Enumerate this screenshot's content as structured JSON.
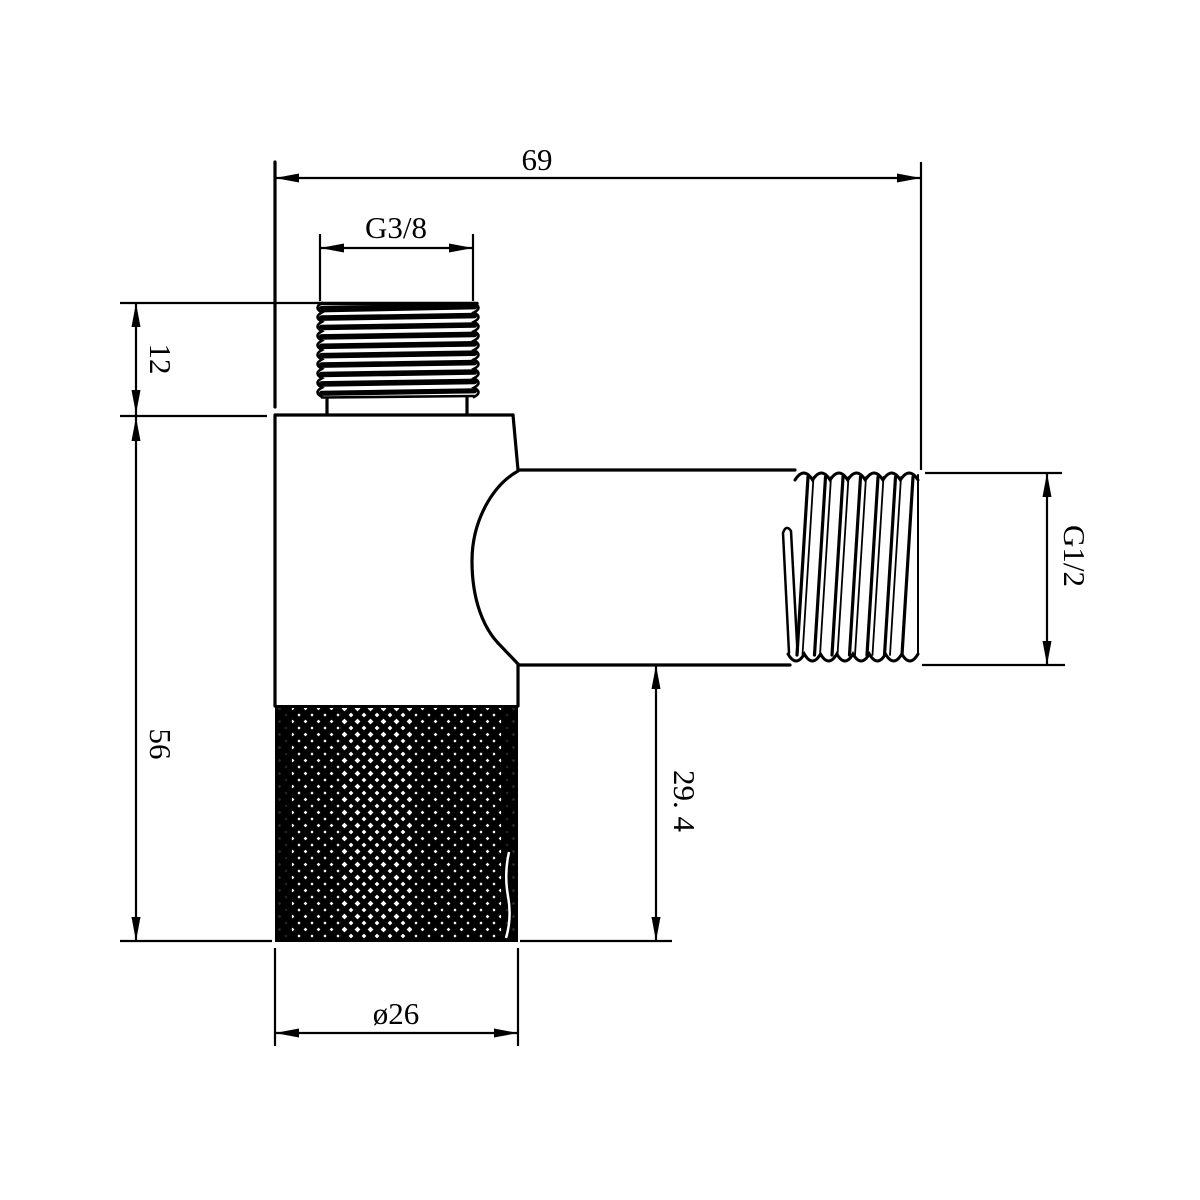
{
  "drawing": {
    "part_name": "angle-valve-dimension-drawing",
    "background": "#ffffff",
    "line_color": "#000000",
    "dimensions": {
      "total_width": {
        "label": "69"
      },
      "inlet_thread": {
        "label": "G3/8"
      },
      "inlet_thread_height": {
        "label": "12"
      },
      "body_height": {
        "label": "56"
      },
      "outlet_thread": {
        "label": "G1/2"
      },
      "outlet_bottom_offset": {
        "label": "29. 4"
      },
      "body_diameter": {
        "label": "ø26"
      }
    }
  }
}
